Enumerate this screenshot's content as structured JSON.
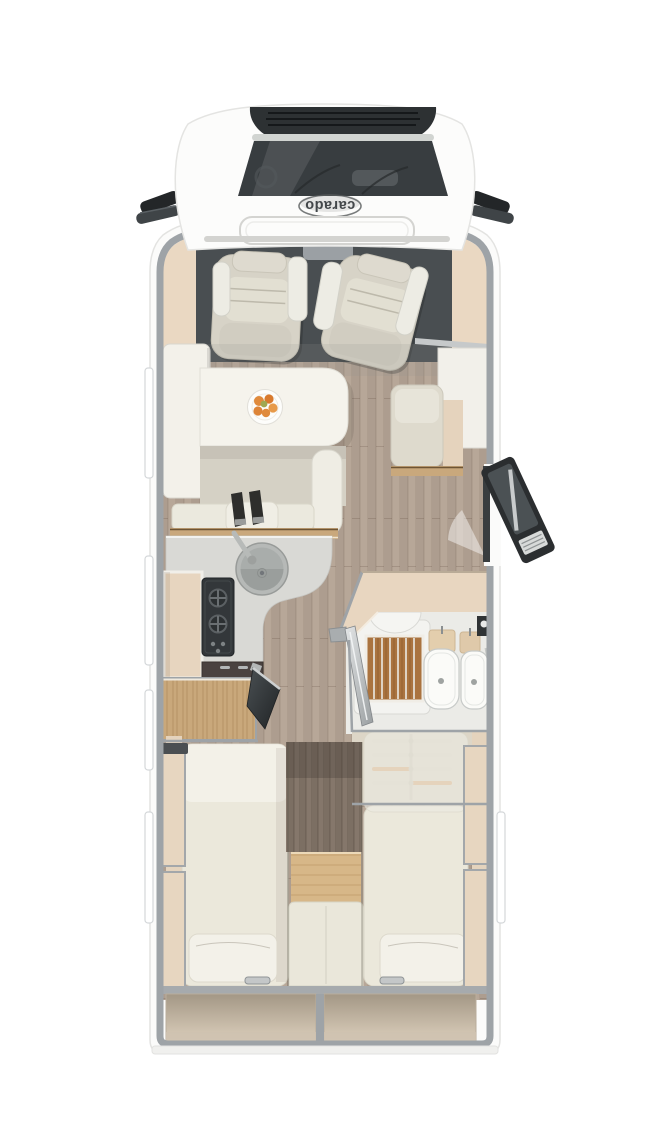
{
  "brand": {
    "logo_text": "carado"
  },
  "palette": {
    "body": "#fbfbfa",
    "wall_gray": "#9ea3a7",
    "cab_floor": "#494e51",
    "dash_beige": "#ead8c2",
    "seat_fabric": "#d7d3c7",
    "floor_wood": "#b7a798",
    "table_white": "#f5f3ec",
    "counter_gray": "#d9d9d5",
    "hob_dark": "#33373a",
    "cabinet_oak": "#c9a87b",
    "shower_teak": "#aa733f",
    "ceramic_white": "#fbfbf8",
    "mattress_cream": "#ebe8db",
    "storage_beige": "#c7b9a6",
    "door_dark": "#2b2e30",
    "step_oak": "#d7b788",
    "fruit_orange": "#e08a3c"
  }
}
